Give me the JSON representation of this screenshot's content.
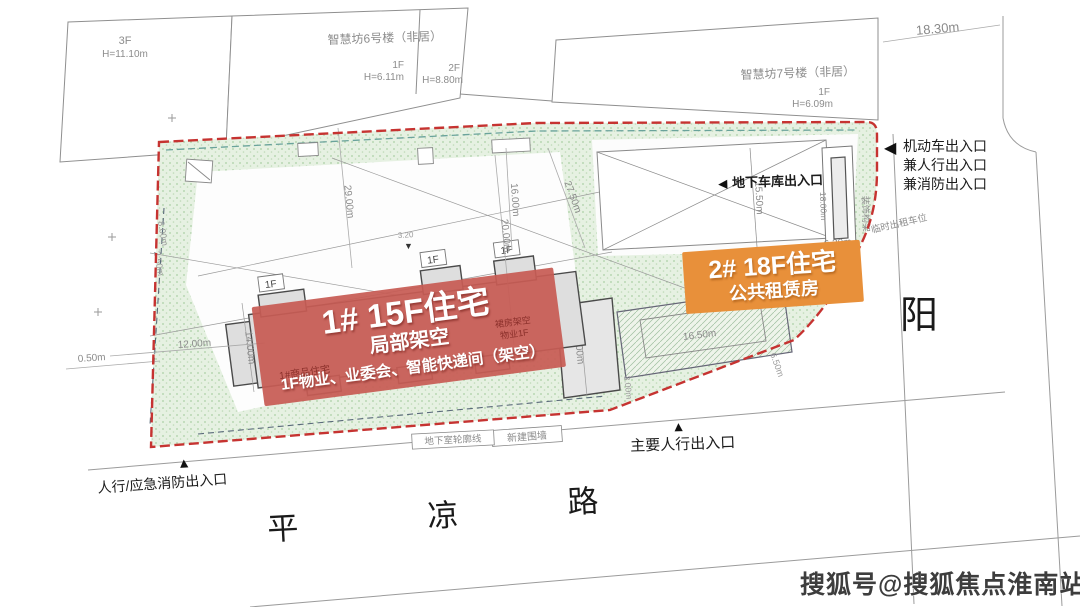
{
  "neighbors": {
    "b6_name": "智慧坊6号楼（非居）",
    "b6_f3": "3F",
    "b6_f3_h": "H=11.10m",
    "b6_f1": "1F",
    "b6_f1_h": "H=6.11m",
    "b6_f2": "2F",
    "b6_f2_h": "H=8.80m",
    "b7_name": "智慧坊7号楼（非居）",
    "b7_f1": "1F",
    "b7_f1_h": "H=6.09m"
  },
  "building1": {
    "title": "1# 15F住宅",
    "subtitle": "局部架空",
    "note": "1F物业、业委会、智能快递间（架空）",
    "underlay_left": "1#商品住宅",
    "underlay_r1": "裙房架空",
    "underlay_r2": "物业1F",
    "unit_label": "1F",
    "overlay_color": "#c75b54"
  },
  "building2": {
    "title": "2# 18F住宅",
    "subtitle": "公共租赁房",
    "overlay_color": "#e8903a"
  },
  "entrances": {
    "motor_1": "机动车出入口",
    "motor_2": "兼人行出入口",
    "motor_3": "兼消防出入口",
    "garage": "地下车库出入口",
    "main_ped": "主要人行出入口",
    "emergency": "人行/应急消防出入口"
  },
  "features": {
    "deco_frame": "装饰构架",
    "deco_frame_small": "装饰构架",
    "taxi": "临时出租车位",
    "new_wall": "新建围墙",
    "basement_outline": "地下室轮廓线",
    "level_mark": "3.20"
  },
  "roads": {
    "south_1": "平",
    "south_2": "凉",
    "south_3": "路",
    "east": "阳"
  },
  "dims": {
    "road_top": "18.30m",
    "court_left": "29.00m",
    "court_m1": "16.00m",
    "court_m2": "20.00m",
    "court_r": "27.50m",
    "ramp": "15.50m",
    "deco": "18.00m",
    "taxi_w": "6.20m",
    "b_mid": "14.00m",
    "b1_left": "14.00m",
    "b2_len": "16.50m",
    "b2_off": "3.00m",
    "b2_diag": "6.50m",
    "edge1": "8.00m",
    "edge2": "2.50m",
    "edge3": "12.00m",
    "edge4": "0.50m"
  },
  "icons": {
    "left_arrow": "◀",
    "up_triangle": "▲",
    "down_triangle": "▼"
  },
  "colors": {
    "boundary_red": "#c63331",
    "green_tint": "#e6f1e2"
  },
  "watermark": "搜狐号@搜狐焦点淮南站"
}
